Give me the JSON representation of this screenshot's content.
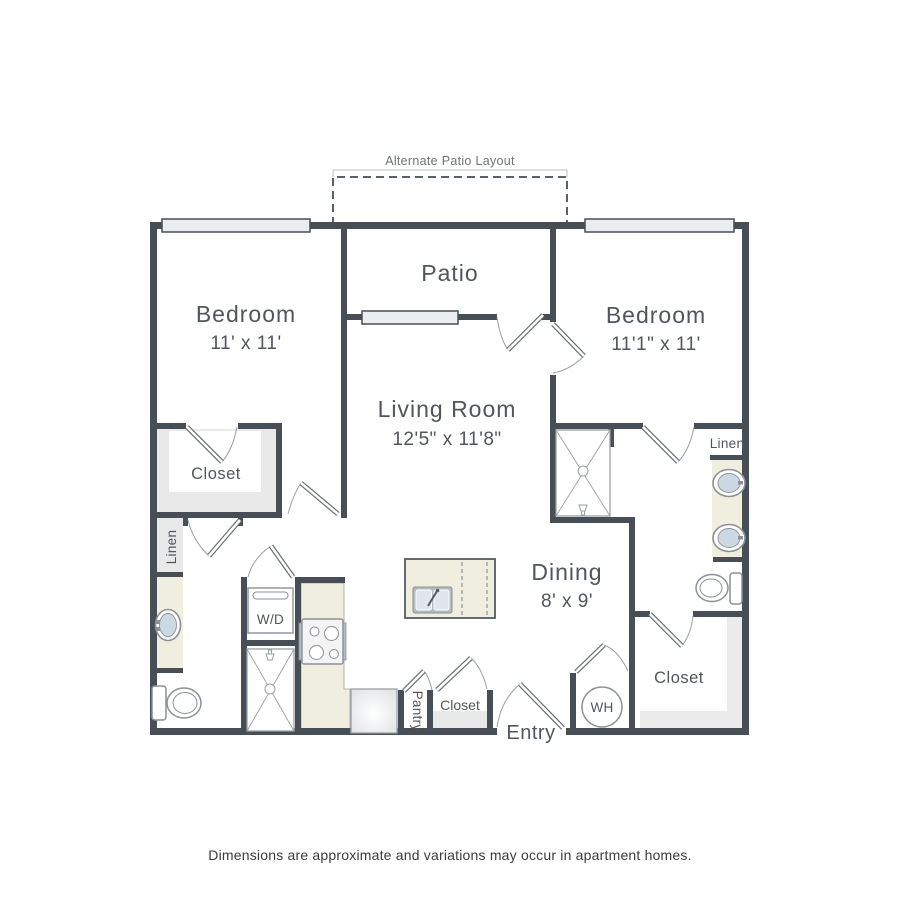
{
  "annotations": {
    "alternate_patio": "Alternate Patio Layout"
  },
  "rooms": {
    "bedroom_left": {
      "name": "Bedroom",
      "dims": "11' x 11'"
    },
    "bedroom_right": {
      "name": "Bedroom",
      "dims": "11'1\" x 11'"
    },
    "living_room": {
      "name": "Living Room",
      "dims": "12'5\" x 11'8\""
    },
    "dining": {
      "name": "Dining",
      "dims": "8' x 9'"
    },
    "patio": {
      "name": "Patio"
    },
    "entry": {
      "name": "Entry"
    },
    "pantry": {
      "name": "Pantry"
    },
    "closet_bedroom_left": {
      "name": "Closet"
    },
    "closet_bedroom_right": {
      "name": "Closet"
    },
    "closet_hall": {
      "name": "Closet"
    },
    "linen_left": {
      "name": "Linen"
    },
    "linen_right": {
      "name": "Linen"
    }
  },
  "fixtures": {
    "washer_dryer": "W/D",
    "water_heater": "WH"
  },
  "colors": {
    "wall": "#474E55",
    "counter": "#F0EEDE",
    "closet_fill": "#E9E9EA",
    "window_fill": "#EAEEF1",
    "fixture_line": "#8B9197",
    "sink_fill": "#CCD9E2",
    "text": "#50565C"
  },
  "footer": {
    "disclaimer": "Dimensions are approximate and variations may occur in apartment homes."
  }
}
